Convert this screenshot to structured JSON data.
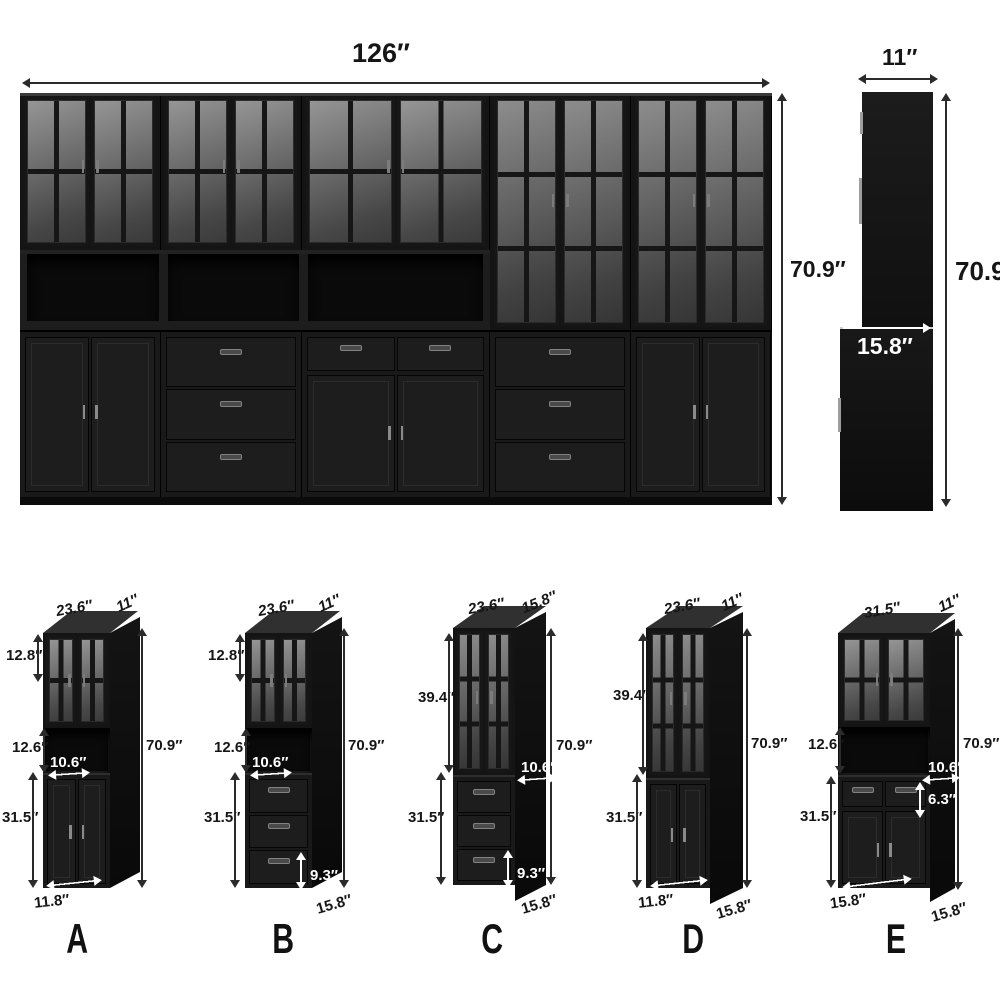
{
  "front_view": {
    "width": "126″",
    "height": "70.9″"
  },
  "side_view": {
    "depth": "11″",
    "height": "70.9″",
    "base_depth": "15.8″"
  },
  "cabinets": [
    {
      "letter": "A",
      "top_width": "23.6″",
      "top_depth": "11″",
      "glass_height": "12.8″",
      "shelf_height": "12.6″",
      "inner_width": "10.6″",
      "total_height": "70.9″",
      "base_height": "31.5″",
      "base_width": "11.8″"
    },
    {
      "letter": "B",
      "top_width": "23.6″",
      "top_depth": "11″",
      "glass_height": "12.8″",
      "shelf_height": "12.6″",
      "inner_width": "10.6″",
      "total_height": "70.9″",
      "base_height": "31.5″",
      "drawer_height": "9.3″",
      "base_depth": "15.8″"
    },
    {
      "letter": "C",
      "top_width": "23.6″",
      "top_depth": "15.8″",
      "glass_height": "39.4″",
      "inner_width": "10.6″",
      "total_height": "70.9″",
      "base_height": "31.5″",
      "drawer_height": "9.3″",
      "base_depth": "15.8″"
    },
    {
      "letter": "D",
      "top_width": "23.6″",
      "top_depth": "11″",
      "glass_height": "39.4″",
      "total_height": "70.9″",
      "base_height": "31.5″",
      "base_width": "11.8″",
      "base_depth": "15.8″"
    },
    {
      "letter": "E",
      "top_width": "31.5″",
      "top_depth": "11″",
      "shelf_height": "12.6″",
      "inner_width": "10.6″",
      "total_height": "70.9″",
      "drawer_height": "6.3″",
      "base_height": "31.5″",
      "base_width": "15.8″",
      "base_depth": "15.8″"
    }
  ],
  "colors": {
    "cabinet_black": "#171717",
    "glass_gray": "#6a6a6a",
    "label_dark": "#161616",
    "label_white": "#ffffff"
  }
}
